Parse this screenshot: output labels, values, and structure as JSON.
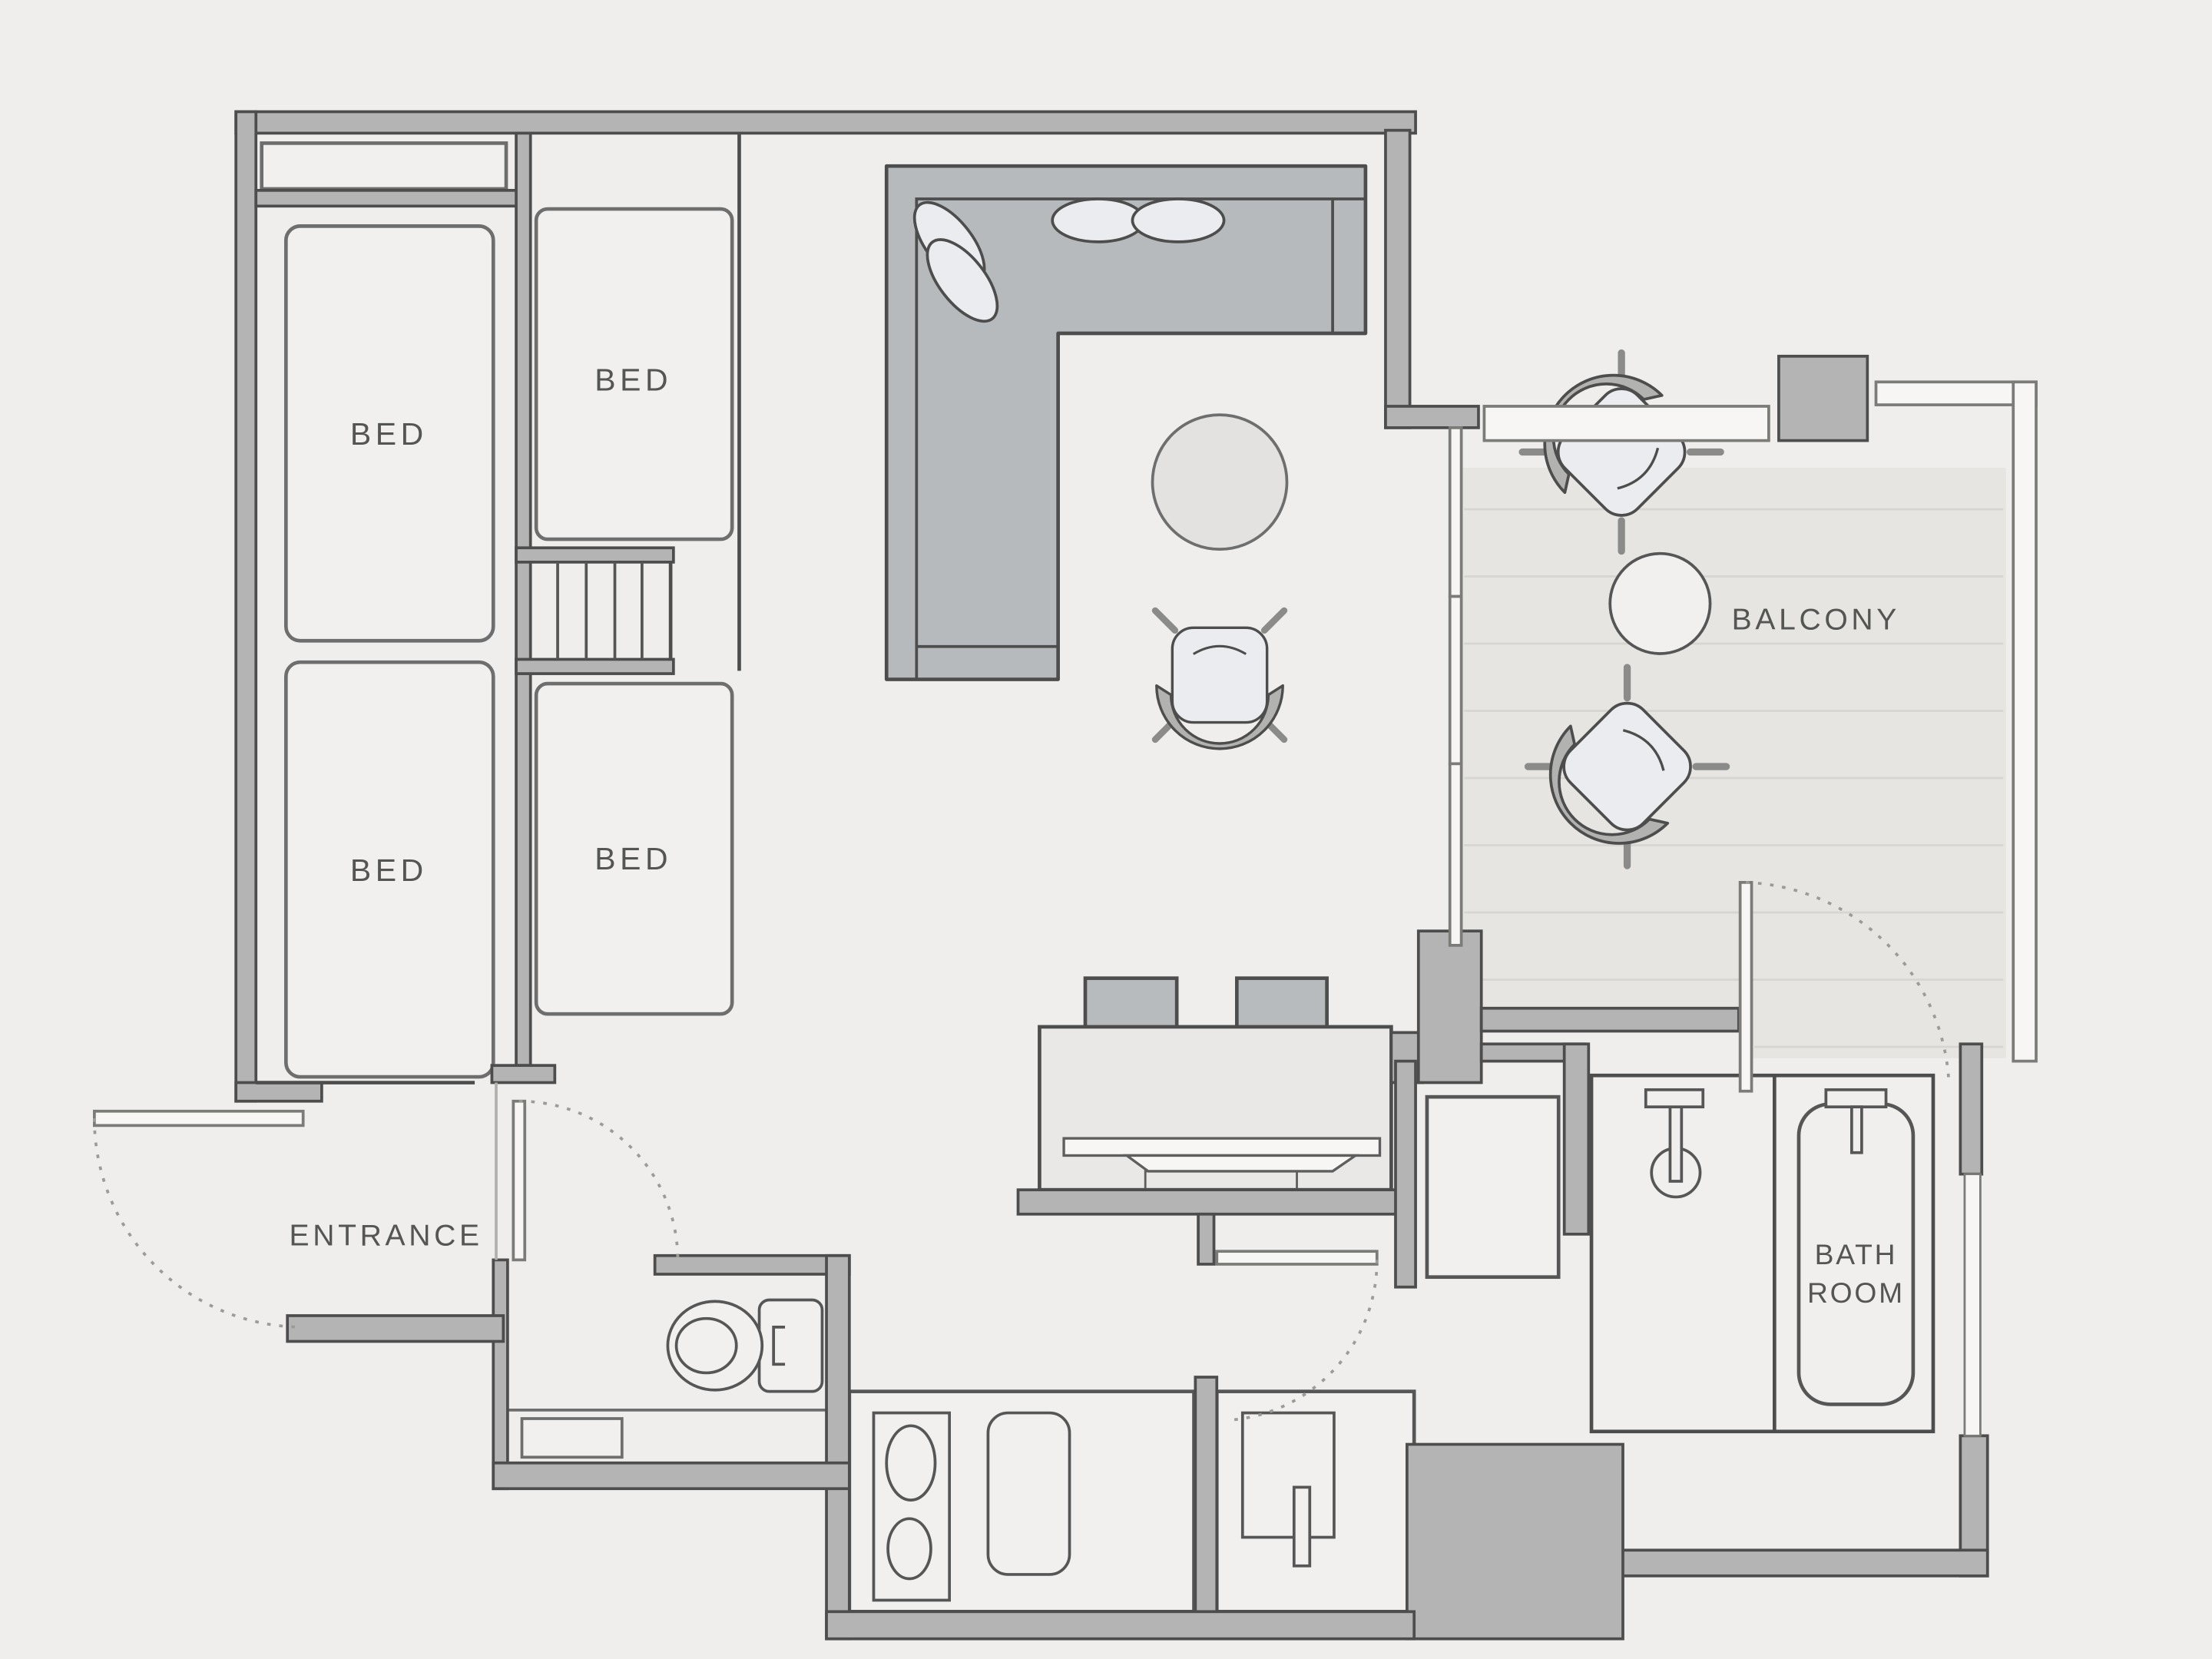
{
  "title": "Apartment floor plan",
  "rooms": {
    "bedroom_left_top": {
      "label": "BED"
    },
    "bedroom_left_bottom": {
      "label": "BED"
    },
    "bedroom_right_top": {
      "label": "BED"
    },
    "bedroom_right_bottom": {
      "label": "BED"
    },
    "balcony": {
      "label": "BALCONY"
    },
    "entrance": {
      "label": "ENTRANCE"
    },
    "bathroom": {
      "label_line1": "BATH",
      "label_line2": "ROOM"
    }
  },
  "colors": {
    "background": "#efeeec",
    "wall_fill": "#b4b4b4",
    "wall_outline": "#4d4d4d",
    "furniture_fill": "#f1f0ee",
    "sofa_fill": "#b6babc",
    "deck_fill": "#e6e5e2",
    "deck_plank_line": "#d6d5d2",
    "cushion_fill": "#eaecef",
    "armrest_fill": "#b2b2b0",
    "door_fill": "#f7f6f4",
    "swing_arc": "#9b9b98",
    "label_text": "#555553"
  }
}
